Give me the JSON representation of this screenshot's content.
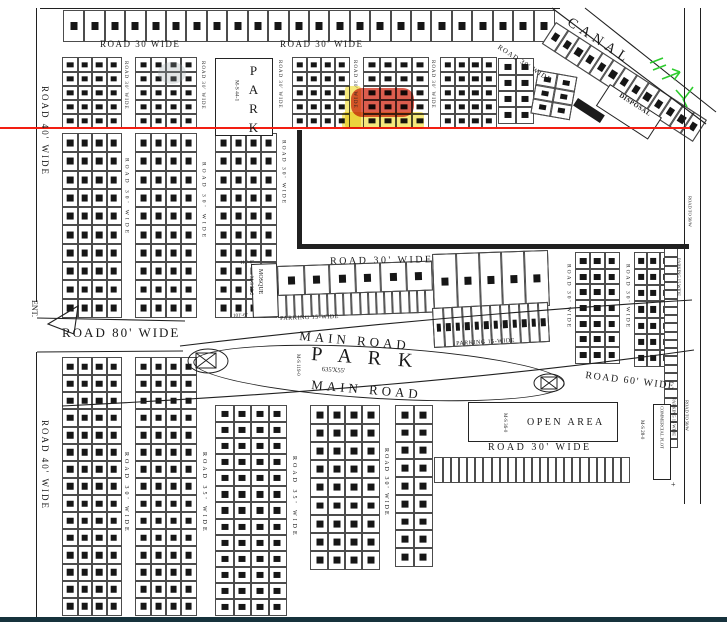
{
  "meta": {
    "drawing_type": "housing scheme plot layout site plan",
    "colors": {
      "paper": "#ffffff",
      "ink": "#1a1a1a",
      "red_line": "#f31e12",
      "highlight_red": "#d6402f",
      "highlight_yellow": "#f2e04e",
      "green_mark": "#2ecc2e",
      "bottom_bar": "#16323c"
    },
    "typical_plot_dims": [
      "5-0",
      "8-0",
      "7-0",
      "3-0",
      "34-6",
      "10-3",
      "11-1",
      "14-6",
      "7-7.5",
      "5-3.5",
      "8-1",
      "7-4",
      "62'-0\"",
      "635'X55'"
    ]
  },
  "labels": [
    {
      "name": "canal-label",
      "text": "CANAL",
      "x": 572,
      "y": 16,
      "fs": 14,
      "rot": 33,
      "ls": 5
    },
    {
      "name": "road-30-canal-label",
      "text": "ROAD  30'  WIDE",
      "x": 500,
      "y": 44,
      "fs": 7,
      "rot": 33,
      "ls": 1
    },
    {
      "name": "disposal-label",
      "text": "DISPOSAL",
      "x": 621,
      "y": 93,
      "fs": 6.5,
      "rot": 33,
      "ls": 0.5,
      "bold": 1
    },
    {
      "name": "road-30-top-a-label",
      "text": "ROAD   30   WIDE",
      "x": 100,
      "y": 40,
      "fs": 9,
      "ls": 1.5
    },
    {
      "name": "road-30-top-b-label",
      "text": "ROAD   30'  WIDE",
      "x": 280,
      "y": 40,
      "fs": 9,
      "ls": 1.5
    },
    {
      "name": "road-40-top-label",
      "text": "ROAD  40'  WIDE",
      "x": 40,
      "y": 86,
      "fs": 9,
      "ls": 2,
      "mode": "v"
    },
    {
      "name": "road-30-v1-label",
      "text": "ROAD  30'  WIDE",
      "x": 123,
      "y": 61,
      "fs": 5,
      "ls": 1,
      "mode": "v"
    },
    {
      "name": "road-30-v2-label",
      "text": "ROAD  30'  WIDE",
      "x": 200,
      "y": 61,
      "fs": 5,
      "ls": 1,
      "mode": "v"
    },
    {
      "name": "road-30-v3-label",
      "text": "ROAD  30'  WIDE",
      "x": 277,
      "y": 60,
      "fs": 5,
      "ls": 1,
      "mode": "v"
    },
    {
      "name": "road-30-v4-label",
      "text": "ROAD  30'  WIDE",
      "x": 352,
      "y": 60,
      "fs": 5,
      "ls": 1,
      "mode": "v"
    },
    {
      "name": "road-30-v5-label",
      "text": "ROAD  30'  WIDE",
      "x": 430,
      "y": 60,
      "fs": 5,
      "ls": 1,
      "mode": "v"
    },
    {
      "name": "road-30-v6-label",
      "text": "ROAD  30'  WIDE",
      "x": 123,
      "y": 158,
      "fs": 5.5,
      "ls": 3,
      "mode": "v"
    },
    {
      "name": "road-30-v7-label",
      "text": "ROAD  30'  WIDE",
      "x": 200,
      "y": 162,
      "fs": 5.5,
      "ls": 3,
      "mode": "v"
    },
    {
      "name": "road-30-v8-label",
      "text": "ROAD  30'  WIDE",
      "x": 280,
      "y": 140,
      "fs": 5.5,
      "ls": 2,
      "mode": "v"
    },
    {
      "name": "road-30-mid-label",
      "text": "ROAD    30'   WIDE",
      "x": 330,
      "y": 257,
      "fs": 10,
      "ls": 2.5,
      "rot": -1
    },
    {
      "name": "mosque-label",
      "text": "MOSQUE",
      "x": 257,
      "y": 269,
      "fs": 6,
      "mode": "v"
    },
    {
      "name": "mosque-ms-label",
      "text": "M-S  39-2",
      "x": 248,
      "y": 276,
      "fs": 5,
      "mode": "v"
    },
    {
      "name": "dim-111-6",
      "text": "111'-6\"",
      "x": 240,
      "y": 261,
      "fs": 5,
      "rot": -3
    },
    {
      "name": "dim-101-6",
      "text": "101'-6\"",
      "x": 233,
      "y": 314,
      "fs": 5,
      "rot": -3
    },
    {
      "name": "parking-a-label",
      "text": "PARKING 15-WIDE",
      "x": 280,
      "y": 316,
      "fs": 6,
      "rot": -2,
      "ls": 0.5
    },
    {
      "name": "parking-b-label",
      "text": "PARKING 15-WIDE",
      "x": 456,
      "y": 341,
      "fs": 6,
      "rot": -3,
      "ls": 0.5
    },
    {
      "name": "main-road-top-label",
      "text": "MAIN    ROAD",
      "x": 300,
      "y": 329,
      "fs": 13,
      "rot": 5,
      "ls": 4
    },
    {
      "name": "park-main-label",
      "text": "P A R K",
      "x": 312,
      "y": 344,
      "fs": 20,
      "rot": 4,
      "ls": 6
    },
    {
      "name": "park-dim-label",
      "text": "635'X55'",
      "x": 322,
      "y": 367,
      "fs": 6.5,
      "rot": 4
    },
    {
      "name": "park-ms-label",
      "text": "M-S 119-0",
      "x": 295,
      "y": 354,
      "fs": 5,
      "mode": "v"
    },
    {
      "name": "main-road-bottom-label",
      "text": "MAIN    ROAD",
      "x": 312,
      "y": 378,
      "fs": 13,
      "rot": 5,
      "ls": 4
    },
    {
      "name": "road-80-label",
      "text": "ROAD   80'   WIDE",
      "x": 62,
      "y": 326,
      "fs": 13,
      "ls": 2
    },
    {
      "name": "road-60-label",
      "text": "ROAD  60'  WIDE",
      "x": 586,
      "y": 371,
      "fs": 10,
      "rot": 7,
      "ls": 1.5
    },
    {
      "name": "road-30-rm1-label",
      "text": "ROAD  30'  WIDE",
      "x": 565,
      "y": 264,
      "fs": 5.5,
      "ls": 2,
      "mode": "v"
    },
    {
      "name": "road-30-rm2-label",
      "text": "ROAD  30'  WIDE",
      "x": 624,
      "y": 264,
      "fs": 5.5,
      "ls": 2,
      "mode": "v"
    },
    {
      "name": "parking-right-top-label",
      "text": "PARKING 15 WIDE",
      "x": 676,
      "y": 258,
      "fs": 4.5,
      "mode": "v"
    },
    {
      "name": "road-to-50w-top-label",
      "text": "ROAD TO 50/W",
      "x": 687,
      "y": 196,
      "fs": 4.5,
      "mode": "v"
    },
    {
      "name": "open-area-label",
      "text": "OPEN  AREA",
      "x": 527,
      "y": 418,
      "fs": 10,
      "ls": 2.5
    },
    {
      "name": "open-area-ms-label",
      "text": "M-S  36-0",
      "x": 502,
      "y": 413,
      "fs": 5,
      "mode": "v"
    },
    {
      "name": "road-30-openarea-label",
      "text": "ROAD    30'   WIDE",
      "x": 488,
      "y": 443,
      "fs": 10,
      "ls": 2.5
    },
    {
      "name": "commercial-plot-label",
      "text": "COMMERCIAL PLOT",
      "x": 659,
      "y": 406,
      "fs": 4.5,
      "mode": "v"
    },
    {
      "name": "ms-28-label",
      "text": "M-S 28-0",
      "x": 639,
      "y": 420,
      "fs": 5,
      "mode": "v"
    },
    {
      "name": "parking-right-bottom-label",
      "text": "PARKING 15 WIDE",
      "x": 671,
      "y": 398,
      "fs": 4.5,
      "mode": "v"
    },
    {
      "name": "road-to-50w-bottom-label",
      "text": "ROAD TO 50/W",
      "x": 684,
      "y": 400,
      "fs": 4.5,
      "mode": "v"
    },
    {
      "name": "road-40-bottom-label",
      "text": "ROAD  40'  WIDE",
      "x": 40,
      "y": 420,
      "fs": 9,
      "ls": 2,
      "mode": "v"
    },
    {
      "name": "road-30-b1-label",
      "text": "ROAD  30'  WIDE",
      "x": 123,
      "y": 452,
      "fs": 6,
      "ls": 3,
      "mode": "v"
    },
    {
      "name": "road-35-a-label",
      "text": "ROAD  35'  WIDE",
      "x": 201,
      "y": 452,
      "fs": 6,
      "ls": 3,
      "mode": "v"
    },
    {
      "name": "road-35-b-label",
      "text": "ROAD  35'  WIDE",
      "x": 291,
      "y": 456,
      "fs": 6,
      "ls": 3,
      "mode": "v"
    },
    {
      "name": "road-30-b2-label",
      "text": "ROAD  30'  WIDE",
      "x": 383,
      "y": 448,
      "fs": 6,
      "ls": 2,
      "mode": "v"
    },
    {
      "name": "ent-label",
      "text": "ENT.",
      "x": 30,
      "y": 300,
      "fs": 8,
      "mode": "v"
    },
    {
      "name": "park-top-label",
      "text": "PARK",
      "x": 247,
      "y": 63,
      "fs": 13,
      "ls": 4,
      "mode": "vu"
    },
    {
      "name": "park-top-ms-label",
      "text": "M-S  44-1",
      "x": 233,
      "y": 80,
      "fs": 5.5,
      "mode": "v"
    },
    {
      "name": "plus-mark",
      "text": "+",
      "x": 671,
      "y": 481,
      "fs": 8
    }
  ],
  "blocks": [
    {
      "name": "plot-row-top",
      "x": 63,
      "y": 10,
      "w": 492,
      "h": 32,
      "rows": 1,
      "cols": 24
    },
    {
      "name": "plot-block-t1",
      "x": 62,
      "y": 57,
      "w": 60,
      "h": 72,
      "rows": 5,
      "cols": 4
    },
    {
      "name": "plot-block-t2",
      "x": 135,
      "y": 57,
      "w": 62,
      "h": 72,
      "rows": 5,
      "cols": 4
    },
    {
      "name": "plot-block-t3",
      "x": 292,
      "y": 57,
      "w": 58,
      "h": 72,
      "rows": 5,
      "cols": 4
    },
    {
      "name": "plot-block-t4",
      "x": 363,
      "y": 57,
      "w": 66,
      "h": 72,
      "rows": 5,
      "cols": 4
    },
    {
      "name": "plot-block-t5",
      "x": 440,
      "y": 57,
      "w": 57,
      "h": 72,
      "rows": 5,
      "cols": 4
    },
    {
      "name": "plot-block-t6",
      "x": 498,
      "y": 58,
      "w": 36,
      "h": 66,
      "rows": 4,
      "cols": 2
    },
    {
      "name": "plot-block-t7",
      "x": 538,
      "y": 70,
      "w": 40,
      "h": 44,
      "rows": 3,
      "cols": 2,
      "rot": 10
    },
    {
      "name": "canal-plot-strip",
      "x": 556,
      "y": 22,
      "w": 180,
      "h": 26,
      "rows": 1,
      "cols": 13,
      "rot": 33
    },
    {
      "name": "plot-block-m1",
      "x": 62,
      "y": 133,
      "w": 60,
      "h": 185,
      "rows": 10,
      "cols": 4
    },
    {
      "name": "plot-block-m2",
      "x": 135,
      "y": 133,
      "w": 62,
      "h": 185,
      "rows": 10,
      "cols": 4
    },
    {
      "name": "plot-block-m3",
      "x": 215,
      "y": 133,
      "w": 62,
      "h": 185,
      "rows": 10,
      "cols": 4
    },
    {
      "name": "shops-row-a",
      "x": 277,
      "y": 266,
      "w": 155,
      "h": 30,
      "rows": 1,
      "cols": 6,
      "rot": -2
    },
    {
      "name": "stalls-row-a",
      "x": 277,
      "y": 295,
      "w": 157,
      "h": 23,
      "rows": 1,
      "cols": 19,
      "rot": -2
    },
    {
      "name": "shops-row-b",
      "x": 432,
      "y": 254,
      "w": 116,
      "h": 56,
      "rows": 1,
      "cols": 5,
      "rot": -2
    },
    {
      "name": "stalls-row-b",
      "x": 432,
      "y": 308,
      "w": 116,
      "h": 40,
      "rows": 1,
      "cols": 12,
      "rot": -3
    },
    {
      "name": "plot-block-r1",
      "x": 575,
      "y": 252,
      "w": 45,
      "h": 112,
      "rows": 7,
      "cols": 3
    },
    {
      "name": "plot-block-r2",
      "x": 634,
      "y": 252,
      "w": 39,
      "h": 115,
      "rows": 7,
      "cols": 3
    },
    {
      "name": "stall-strip-right",
      "x": 664,
      "y": 248,
      "w": 14,
      "h": 200,
      "rows": 24,
      "cols": 1
    },
    {
      "name": "plot-block-b1",
      "x": 62,
      "y": 357,
      "w": 60,
      "h": 259,
      "rows": 15,
      "cols": 4
    },
    {
      "name": "plot-block-b2",
      "x": 135,
      "y": 357,
      "w": 62,
      "h": 259,
      "rows": 15,
      "cols": 4
    },
    {
      "name": "plot-block-b3",
      "x": 215,
      "y": 405,
      "w": 72,
      "h": 211,
      "rows": 13,
      "cols": 4
    },
    {
      "name": "plot-block-b4",
      "x": 310,
      "y": 405,
      "w": 70,
      "h": 165,
      "rows": 9,
      "cols": 4
    },
    {
      "name": "plot-block-b5",
      "x": 395,
      "y": 405,
      "w": 38,
      "h": 162,
      "rows": 9,
      "cols": 2
    },
    {
      "name": "stalls-row-openarea",
      "x": 434,
      "y": 457,
      "w": 196,
      "h": 26,
      "rows": 1,
      "cols": 24
    }
  ],
  "rects": [
    {
      "name": "park-top-box",
      "x": 215,
      "y": 58,
      "w": 58,
      "h": 78
    },
    {
      "name": "mosque-box",
      "x": 251,
      "y": 264,
      "w": 26,
      "h": 54,
      "rot": -2
    },
    {
      "name": "open-area-box",
      "x": 468,
      "y": 402,
      "w": 150,
      "h": 40
    },
    {
      "name": "commercial-plot-box",
      "x": 653,
      "y": 404,
      "w": 18,
      "h": 76
    },
    {
      "name": "disposal-box",
      "x": 610,
      "y": 84,
      "w": 62,
      "h": 26,
      "rot": 33
    },
    {
      "name": "disposal-bar",
      "x": 578,
      "y": 98,
      "w": 32,
      "h": 9,
      "rot": 33,
      "fill": "#1b1b1b"
    }
  ],
  "lines": [
    {
      "name": "boundary-top",
      "x": 40,
      "y": 8,
      "w": 520,
      "h": 1.2
    },
    {
      "name": "boundary-left-upper",
      "x": 36,
      "y": 8,
      "w": 1.2,
      "h": 294
    },
    {
      "name": "boundary-left-lower",
      "x": 36,
      "y": 352,
      "w": 1.2,
      "h": 266
    },
    {
      "name": "corridor-line-1",
      "x": 684,
      "y": 8,
      "w": 1,
      "h": 496
    },
    {
      "name": "corridor-line-2",
      "x": 700,
      "y": 8,
      "w": 1,
      "h": 496
    },
    {
      "name": "thick-border-vertical",
      "x": 297,
      "y": 130,
      "w": 5,
      "h": 119
    },
    {
      "name": "thick-border-horizontal",
      "x": 297,
      "y": 244,
      "w": 392,
      "h": 5
    }
  ],
  "red_line": {
    "name": "red-boundary-line",
    "x": 0,
    "y": 127,
    "w": 690,
    "h": 2.4
  },
  "bottom_bar": {
    "name": "bottom-bar",
    "x": 0,
    "y": 617,
    "w": 727,
    "h": 5
  },
  "highlights": [
    {
      "name": "selected-plots-yellow-vertical",
      "x": 345,
      "y": 86,
      "w": 16,
      "h": 42,
      "color": "#f2e04e",
      "opacity": 0.75,
      "radius": 3
    },
    {
      "name": "selected-plots-yellow-row",
      "x": 342,
      "y": 112,
      "w": 82,
      "h": 17,
      "color": "#f2e04e",
      "opacity": 0.75,
      "radius": 3
    },
    {
      "name": "selected-plots-red",
      "x": 351,
      "y": 88,
      "w": 63,
      "h": 29,
      "color": "#d6402f",
      "opacity": 0.85,
      "radius": 11
    }
  ],
  "park_oval": {
    "name": "park-oval",
    "x": 193,
    "y": 347,
    "w": 370,
    "h": 50,
    "rot": 3.4
  }
}
